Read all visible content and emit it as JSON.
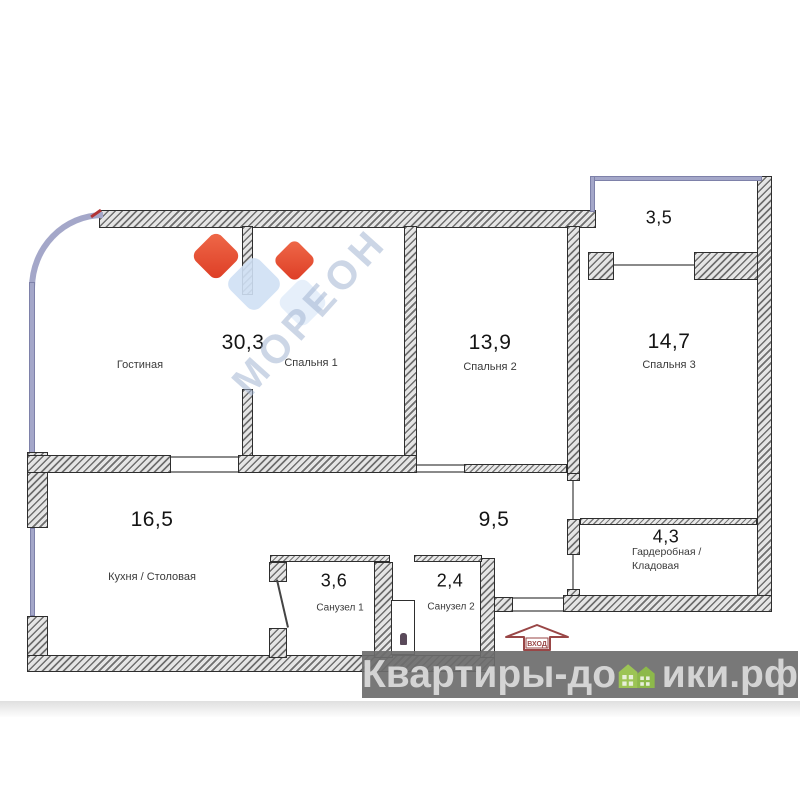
{
  "rooms": {
    "living": {
      "area": "30,3",
      "label": "Гостиная"
    },
    "bedroom1": {
      "label": "Спальня 1"
    },
    "bedroom2": {
      "area": "13,9",
      "label": "Спальня 2"
    },
    "bedroom3": {
      "area": "14,7",
      "label": "Спальня 3"
    },
    "balcony": {
      "area": "3,5"
    },
    "kitchen": {
      "area": "16,5",
      "label": "Кухня / Столовая"
    },
    "hallway": {
      "area": "9,5"
    },
    "bathroom1": {
      "area": "3,6",
      "label": "Санузел 1"
    },
    "bathroom2": {
      "area": "2,4",
      "label": "Санузел 2"
    },
    "wardrobe": {
      "area": "4,3",
      "label_line1": "Гардеробная /",
      "label_line2": "Кладовая"
    }
  },
  "entrance": {
    "label": "ВХОД"
  },
  "watermarks": {
    "diagonal": {
      "text": "МОРЕОН"
    },
    "footer": {
      "prefix": "Квартиры-до",
      "suffix": "ики.рф"
    }
  },
  "icons": {
    "houses": "green-houses-icon",
    "entrance_arrow": "entrance-arrow-icon",
    "toilet": "toilet-icon"
  },
  "colors": {
    "wall_outline": "#2e2e2e",
    "glazing": "#a4a7c9",
    "logo_red": "#e0452c",
    "logo_blue": "#cfe0f4",
    "footer_green": "#9cc455",
    "footer_band": "#6c6c6c",
    "footer_text": "#d4d4d4",
    "entrance_red": "#994646"
  }
}
